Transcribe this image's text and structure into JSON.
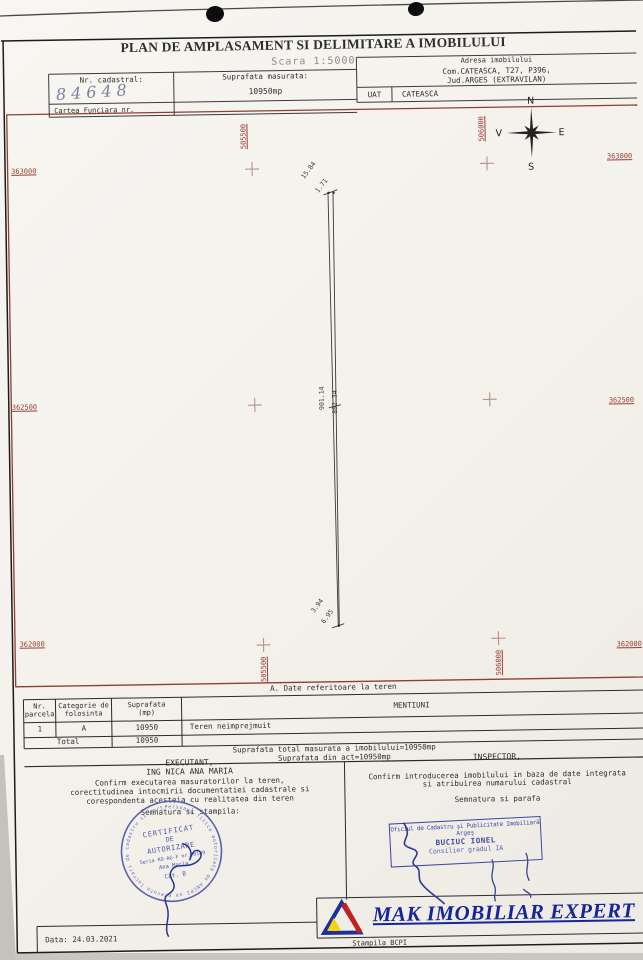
{
  "document": {
    "title": "PLAN DE AMPLASAMENT SI DELIMITARE A IMOBILULUI",
    "scale": "Scara 1:5000",
    "date": "Data: 24.03.2021",
    "stamp_note": "Stampila BCPI"
  },
  "header": {
    "nr_cadastral_label": "Nr. cadastral:",
    "nr_cadastral_value": "84648",
    "suprafata_label": "Suprafata masurata:",
    "suprafata_value": "10950mp",
    "adresa_label": "Adresa imobilului",
    "adresa_line1": "Com.CATEASCA, T27, P396,",
    "adresa_line2": "Jud.ARGES (EXTRAVILAN)",
    "uat_label": "UAT",
    "uat_value": "CATEASCA",
    "cartea_funciara_label": "Cartea Funciara nr."
  },
  "compass": {
    "north": "N",
    "east": "E",
    "south": "S",
    "west": "V"
  },
  "map": {
    "left_labels": [
      "363000",
      "362500",
      "362000"
    ],
    "right_labels": [
      "363000",
      "362500",
      "362000"
    ],
    "top_vertical_labels": [
      "505500",
      "506000"
    ],
    "bottom_vertical_labels": [
      "505500",
      "506000"
    ],
    "dims": {
      "top_a": "15.84",
      "top_b": "1.71",
      "side_left": "901.14",
      "side_right": "892.34",
      "bottom_a": "3.94",
      "bottom_b": "6.95"
    }
  },
  "land_table": {
    "section_title": "A. Date referitoare la teren",
    "col_nr": "Nr.\nparcela",
    "col_categorie": "Categorie de\nfolosinta",
    "col_suprafata": "Suprafata\n(mp)",
    "col_mentiuni": "MENTIUNI",
    "row": {
      "nr": "1",
      "categorie": "A",
      "suprafata": "10950",
      "mentiuni": "Teren neimprejmuit"
    },
    "total_label": "Total",
    "total_value": "10950",
    "summary_line1": "Suprafata total masurata a imobilului=10950mp",
    "summary_line2": "Suprafata din act=10950mp"
  },
  "executant": {
    "title": "EXECUTANT,",
    "name": "ING NICA ANA MARIA",
    "line1": "Confirm executarea masuratorilor la teren,",
    "line2": "corectitudinea intocmirii documentatiei cadastrale si",
    "line3": "corespondenta acesteia cu realitatea din teren",
    "signature_label": "Semnatura si stampila:"
  },
  "inspector": {
    "title": "INSPECTOR,",
    "line1": "Confirm introducerea imobilului in baza de date integrata",
    "line2": "si atribuirea numarului cadastral",
    "signature_label": "Semnatura si parafa"
  },
  "round_stamp": {
    "ring": "Persoana fizica autorizata de ANCPI sa execute lucrari de cadastru si cartografie",
    "l1": "CERTIFICAT",
    "l2": "DE",
    "l3": "AUTORIZARE",
    "l4": "Seria RO-AG-F nr. 0189",
    "l5": "Ana Maria",
    "l6": "Cat. B"
  },
  "rect_stamp": {
    "l1": "Oficiul de Cadastru şi Publicitate Imobiliară",
    "l2": "Argeş",
    "l3": "BUCIUC IONEL",
    "l4": "Consilier gradul IA"
  },
  "logo": {
    "text": "MAK IMOBILIAR EXPERT"
  },
  "colors": {
    "frame_red": "#8e3f34",
    "stamp_blue": "#3c47a0",
    "logo_blue": "#15259b"
  }
}
